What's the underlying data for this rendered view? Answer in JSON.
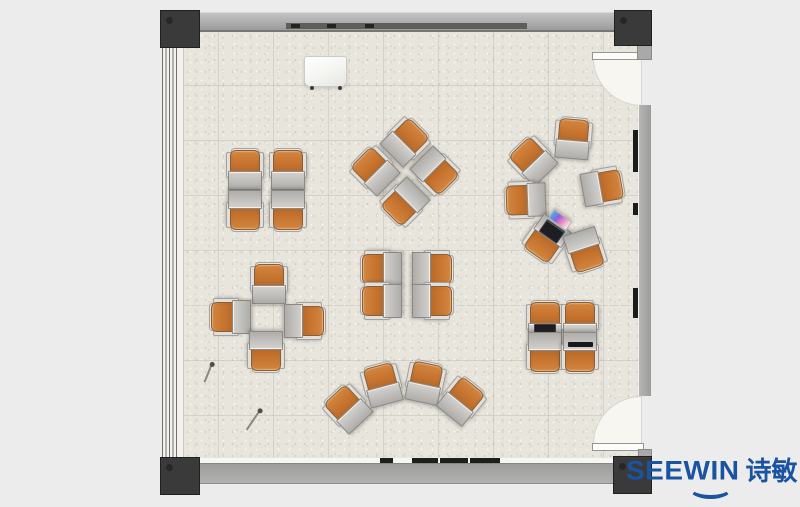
{
  "brand": {
    "name": "SEEWIN",
    "cn": "诗敏",
    "color": "#1a53a1"
  },
  "palette": {
    "background": "#ececec",
    "floor": "#e8e5dd",
    "wall": "#a9a9a9",
    "column": "#3a3a3a",
    "chair_orange": "#c4722e",
    "desk_gray": "#b5b3af",
    "door_swing": "#f7f6f1",
    "mark_dark": "#1e1e1c"
  },
  "room": {
    "doors": 2,
    "door_side": "right",
    "window_side": "left",
    "columns": 4
  },
  "furniture": {
    "units": [
      {
        "cluster": "top-left-quad",
        "x": 245,
        "y": 169,
        "r": 0
      },
      {
        "cluster": "top-left-quad",
        "x": 288,
        "y": 169,
        "r": 0
      },
      {
        "cluster": "top-left-quad",
        "x": 245,
        "y": 211,
        "r": 180
      },
      {
        "cluster": "top-left-quad",
        "x": 288,
        "y": 211,
        "r": 180
      },
      {
        "cluster": "center-top-pinwheel",
        "x": 406,
        "y": 141,
        "r": 45
      },
      {
        "cluster": "center-top-pinwheel",
        "x": 436,
        "y": 172,
        "r": 135
      },
      {
        "cluster": "center-top-pinwheel",
        "x": 404,
        "y": 203,
        "r": 225
      },
      {
        "cluster": "center-top-pinwheel",
        "x": 374,
        "y": 170,
        "r": -45
      },
      {
        "cluster": "right-circle",
        "x": 573,
        "y": 138,
        "r": 5
      },
      {
        "cluster": "right-circle",
        "x": 532,
        "y": 160,
        "r": -44
      },
      {
        "cluster": "right-circle",
        "x": 525,
        "y": 200,
        "r": -92
      },
      {
        "cluster": "right-circle",
        "x": 546,
        "y": 240,
        "r": -145,
        "laptop": true
      },
      {
        "cluster": "right-circle",
        "x": 585,
        "y": 251,
        "r": 162
      },
      {
        "cluster": "right-circle",
        "x": 603,
        "y": 187,
        "r": 80
      },
      {
        "cluster": "left-cross",
        "x": 269,
        "y": 283,
        "r": 0
      },
      {
        "cluster": "left-cross",
        "x": 230,
        "y": 317,
        "r": -90
      },
      {
        "cluster": "left-cross",
        "x": 305,
        "y": 321,
        "r": 90
      },
      {
        "cluster": "left-cross",
        "x": 266,
        "y": 352,
        "r": 180
      },
      {
        "cluster": "center-quad",
        "x": 381,
        "y": 269,
        "r": -90
      },
      {
        "cluster": "center-quad",
        "x": 433,
        "y": 269,
        "r": 90
      },
      {
        "cluster": "center-quad",
        "x": 381,
        "y": 301,
        "r": -90
      },
      {
        "cluster": "center-quad",
        "x": 433,
        "y": 301,
        "r": 90
      },
      {
        "cluster": "bottom-fan",
        "x": 347,
        "y": 408,
        "r": -43
      },
      {
        "cluster": "bottom-fan",
        "x": 382,
        "y": 384,
        "r": -15
      },
      {
        "cluster": "bottom-fan",
        "x": 425,
        "y": 382,
        "r": 12
      },
      {
        "cluster": "bottom-fan",
        "x": 462,
        "y": 400,
        "r": 39
      },
      {
        "cluster": "bottom-right-quad",
        "x": 545,
        "y": 321,
        "r": 0,
        "laptop": true
      },
      {
        "cluster": "bottom-right-quad",
        "x": 580,
        "y": 321,
        "r": 0
      },
      {
        "cluster": "bottom-right-quad",
        "x": 545,
        "y": 353,
        "r": 180
      },
      {
        "cluster": "bottom-right-quad",
        "x": 580,
        "y": 353,
        "r": 180,
        "tablet": true
      }
    ],
    "objects": [
      {
        "type": "whiteboard",
        "x": 304,
        "y": 56,
        "w": 41,
        "h": 29
      },
      {
        "type": "stick",
        "x": 207,
        "y": 364,
        "len": 19,
        "r": 22
      },
      {
        "type": "stick",
        "x": 252,
        "y": 409,
        "len": 23,
        "r": 34
      }
    ],
    "wall_marks": {
      "top_ticks_x": [
        291,
        327,
        365
      ],
      "bottom_dashes": [
        [
          380,
          13
        ],
        [
          412,
          26
        ],
        [
          440,
          28
        ],
        [
          470,
          30
        ]
      ],
      "right_marks": [
        [
          130,
          42
        ],
        [
          203,
          12
        ],
        [
          288,
          30
        ]
      ]
    }
  }
}
